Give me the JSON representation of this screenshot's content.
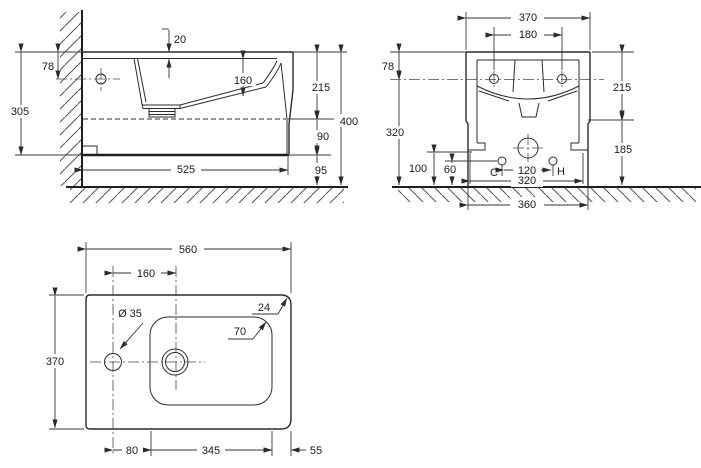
{
  "drawing_type": "technical dimension drawing, three orthographic views of a wall-hung basin",
  "colors": {
    "background": "#ffffff",
    "line": "#2b2b2b",
    "dim_line": "#333333",
    "text": "#1b1b1b",
    "hatch": "#555555"
  },
  "views": {
    "side": {
      "name": "side section view (wall mounted)",
      "t20": "20",
      "t78": "78",
      "t305": "305",
      "t160": "160",
      "t215": "215",
      "t400": "400",
      "t90": "90",
      "t95": "95",
      "t525": "525"
    },
    "front": {
      "name": "front section view",
      "t370": "370",
      "t180": "180",
      "t78": "78",
      "t320": "320",
      "t215": "215",
      "t185": "185",
      "t100": "100",
      "t60": "60",
      "tC": "C",
      "t120": "120",
      "tH": "H",
      "t320b": "320",
      "t360": "360"
    },
    "plan": {
      "name": "plan (top) view",
      "t560": "560",
      "t160": "160",
      "t35": "Ø 35",
      "t24": "24",
      "t70": "70",
      "t370": "370",
      "t80": "80",
      "t345": "345",
      "t55": "55"
    }
  }
}
